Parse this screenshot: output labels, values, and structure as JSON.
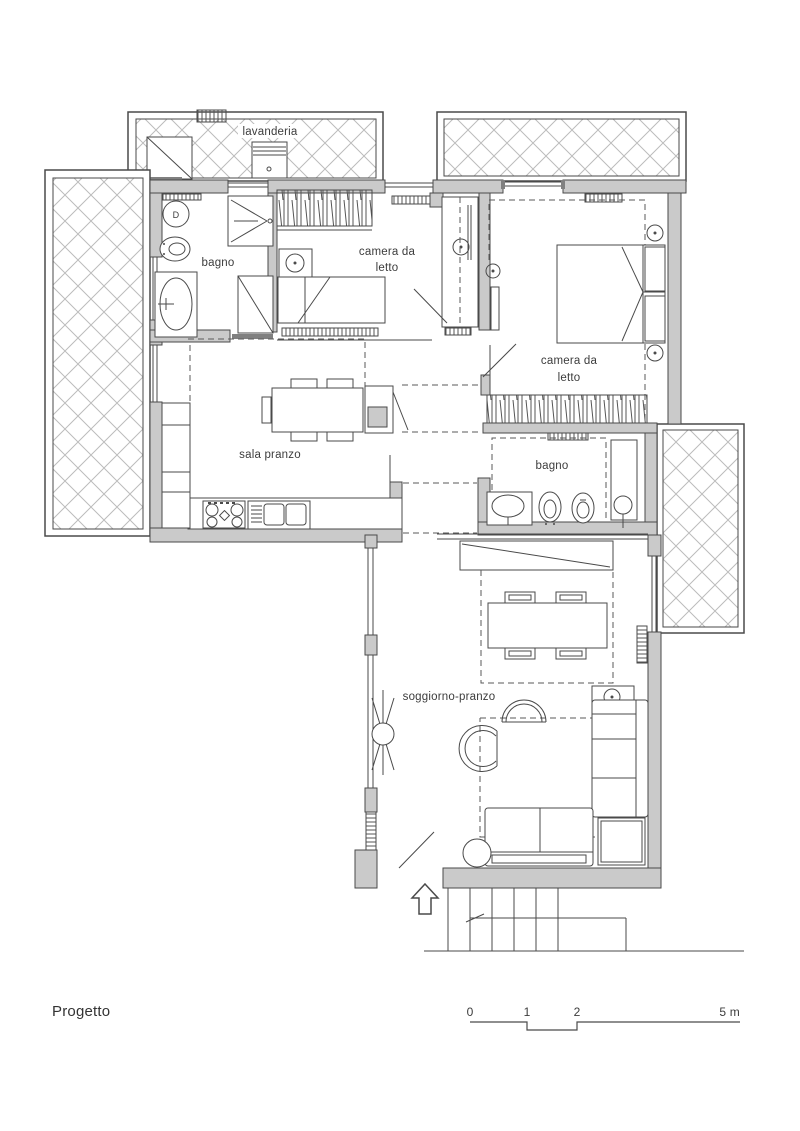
{
  "title": {
    "project_label": "Progetto"
  },
  "plan": {
    "rooms": {
      "lavanderia": {
        "label": "lavanderia"
      },
      "bagno_upper": {
        "label": "bagno"
      },
      "camera_letto_1": {
        "line1": "camera da",
        "line2": "letto"
      },
      "camera_letto_2": {
        "line1": "camera da",
        "line2": "letto"
      },
      "sala_pranzo": {
        "label": "sala pranzo"
      },
      "bagno_lower": {
        "label": "bagno"
      },
      "soggiorno": {
        "label": "soggiorno-pranzo"
      }
    },
    "fixtures": {
      "wc_marker": "D"
    },
    "icons": [
      "washing-machine-icon",
      "shower-icon",
      "toilet-icon",
      "bidet-icon",
      "bathtub-icon",
      "sink-icon",
      "stove-icon",
      "kitchen-sink-icon",
      "single-bed-icon",
      "double-bed-icon",
      "wardrobe-icon",
      "nightstand-icon",
      "ceiling-light-icon",
      "radiator-icon",
      "dining-table-icon",
      "chair-icon",
      "stool-icon",
      "armchair-icon",
      "sofa-icon",
      "coffee-table-icon",
      "side-table-icon",
      "fan-coil-icon",
      "entrance-arrow-icon",
      "stairs-icon",
      "door-swing-icon",
      "window-icon"
    ]
  },
  "scale_bar": {
    "tick0": "0",
    "tick1": "1",
    "tick2": "2",
    "tick5": "5 m"
  },
  "colors": {
    "wall_fill": "#cacaca",
    "line": "#4a4a4a",
    "hatch": "#bcbcbc",
    "dashed": "#5a5a5a",
    "threshold": "#808080",
    "background": "#ffffff"
  }
}
